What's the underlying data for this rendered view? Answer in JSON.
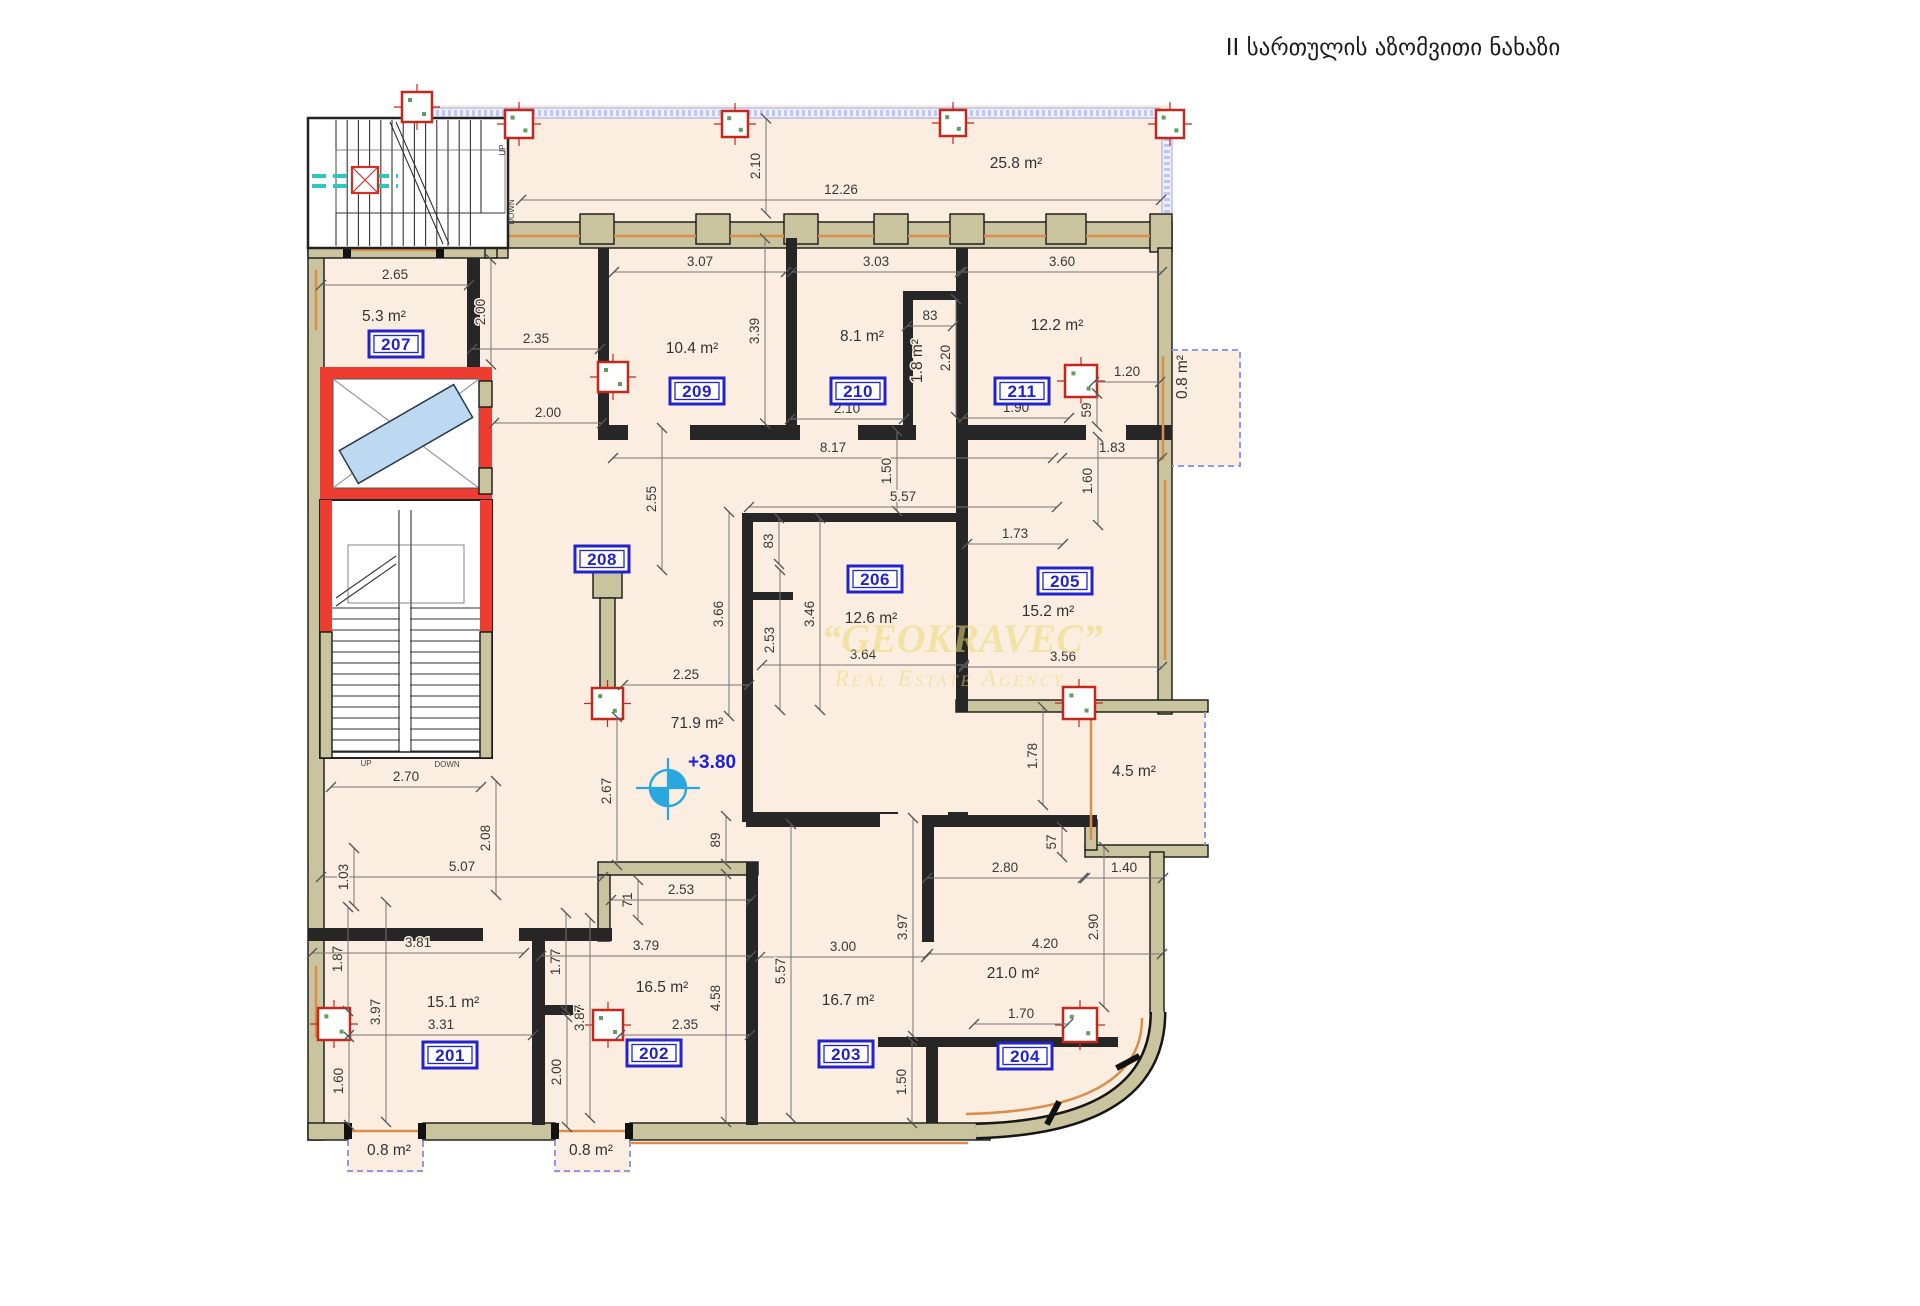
{
  "title": "II სართულის აზომვითი ნახაზი",
  "watermark": {
    "line1": "“GEOKRAVEC”",
    "line2": "Real Estate Agency"
  },
  "elevation": "+3.80",
  "accent_colors": {
    "wall_khaki": "#c9c49e",
    "room_fill": "#fbeee0",
    "label_blue": "#2323cc",
    "column_red": "#c4281c",
    "elevator_red": "#ee3c30",
    "railing_lavender": "#8f9be0",
    "window_orange": "#d98e4a",
    "watermark_gold": "#eed976",
    "survey_blue": "#2ba7e0",
    "section_teal": "#2cc8bc"
  },
  "rooms": [
    {
      "num": "201",
      "bx": 450,
      "by": 1055,
      "area": "15.1 m²",
      "ax": 453,
      "ay": 1007
    },
    {
      "num": "202",
      "bx": 654,
      "by": 1053,
      "area": "16.5 m²",
      "ax": 662,
      "ay": 992
    },
    {
      "num": "203",
      "bx": 846,
      "by": 1054,
      "area": "16.7 m²",
      "ax": 848,
      "ay": 1005
    },
    {
      "num": "204",
      "bx": 1025,
      "by": 1056,
      "area": "21.0 m²",
      "ax": 1013,
      "ay": 978
    },
    {
      "num": "205",
      "bx": 1065,
      "by": 581,
      "area": "15.2 m²",
      "ax": 1048,
      "ay": 616
    },
    {
      "num": "206",
      "bx": 875,
      "by": 579,
      "area": "12.6 m²",
      "ax": 871,
      "ay": 623
    },
    {
      "num": "207",
      "bx": 396,
      "by": 344,
      "area": "5.3 m²",
      "ax": 384,
      "ay": 321
    },
    {
      "num": "208",
      "bx": 602,
      "by": 559,
      "area": "",
      "ax": 0,
      "ay": 0
    },
    {
      "num": "209",
      "bx": 697,
      "by": 391,
      "area": "10.4 m²",
      "ax": 692,
      "ay": 353
    },
    {
      "num": "210",
      "bx": 858,
      "by": 391,
      "area": "8.1 m²",
      "ax": 862,
      "ay": 341
    },
    {
      "num": "211",
      "bx": 1022,
      "by": 391,
      "area": "12.2 m²",
      "ax": 1057,
      "ay": 330
    }
  ],
  "open_areas": [
    {
      "t": "25.8 m²",
      "x": 1016,
      "y": 168,
      "r": 0
    },
    {
      "t": "1.8 m²",
      "x": 922,
      "y": 361,
      "r": -90
    },
    {
      "t": "0.8 m²",
      "x": 1187,
      "y": 377,
      "r": -90
    },
    {
      "t": "4.5 m²",
      "x": 1134,
      "y": 776,
      "r": 0
    },
    {
      "t": "71.9 m²",
      "x": 697,
      "y": 728,
      "r": 0
    },
    {
      "t": "0.8 m²",
      "x": 389,
      "y": 1155,
      "r": 0
    },
    {
      "t": "0.8 m²",
      "x": 591,
      "y": 1155,
      "r": 0
    }
  ],
  "dims": [
    {
      "t": "2.10",
      "x": 760,
      "y": 166,
      "r": -90,
      "l": 95
    },
    {
      "t": "12.26",
      "x": 841,
      "y": 194,
      "r": 0,
      "l": 640
    },
    {
      "t": "2.65",
      "x": 395,
      "y": 279,
      "r": 0,
      "l": 148
    },
    {
      "t": "3.07",
      "x": 700,
      "y": 266,
      "r": 0,
      "l": 172
    },
    {
      "t": "3.03",
      "x": 876,
      "y": 266,
      "r": 0,
      "l": 168
    },
    {
      "t": "3.60",
      "x": 1062,
      "y": 266,
      "r": 0,
      "l": 200
    },
    {
      "t": "2.00",
      "x": 485,
      "y": 312,
      "r": -90,
      "l": 105
    },
    {
      "t": "2.35",
      "x": 536,
      "y": 343,
      "r": 0,
      "l": 128
    },
    {
      "t": "83",
      "x": 930,
      "y": 320,
      "r": 0,
      "l": 46
    },
    {
      "t": "2.20",
      "x": 950,
      "y": 358,
      "r": -90,
      "l": 118
    },
    {
      "t": "3.39",
      "x": 759,
      "y": 331,
      "r": -90,
      "l": 185
    },
    {
      "t": "2.10",
      "x": 847,
      "y": 413,
      "r": 0,
      "l": 114
    },
    {
      "t": "1.90",
      "x": 1016,
      "y": 412,
      "r": 0,
      "l": 106
    },
    {
      "t": "1.20",
      "x": 1127,
      "y": 376,
      "r": 0,
      "l": 66
    },
    {
      "t": "59",
      "x": 1091,
      "y": 410,
      "r": -90,
      "l": 33
    },
    {
      "t": "2.00",
      "x": 548,
      "y": 417,
      "r": 0,
      "l": 108
    },
    {
      "t": "8.17",
      "x": 833,
      "y": 452,
      "r": 0,
      "l": 440
    },
    {
      "t": "1.50",
      "x": 891,
      "y": 471,
      "r": -90,
      "l": 80
    },
    {
      "t": "5.57",
      "x": 903,
      "y": 501,
      "r": 0,
      "l": 308
    },
    {
      "t": "1.83",
      "x": 1112,
      "y": 452,
      "r": 0,
      "l": 100
    },
    {
      "t": "1.60",
      "x": 1092,
      "y": 481,
      "r": -90,
      "l": 88
    },
    {
      "t": "1.73",
      "x": 1015,
      "y": 538,
      "r": 0,
      "l": 96
    },
    {
      "t": "2.55",
      "x": 656,
      "y": 499,
      "r": -90,
      "l": 142
    },
    {
      "t": "3.66",
      "x": 723,
      "y": 614,
      "r": -90,
      "l": 204
    },
    {
      "t": "83",
      "x": 773,
      "y": 541,
      "r": -90,
      "l": 46
    },
    {
      "t": "2.53",
      "x": 774,
      "y": 640,
      "r": -90,
      "l": 140
    },
    {
      "t": "3.46",
      "x": 814,
      "y": 614,
      "r": -90,
      "l": 192
    },
    {
      "t": "3.64",
      "x": 863,
      "y": 659,
      "r": 0,
      "l": 202
    },
    {
      "t": "2.25",
      "x": 686,
      "y": 679,
      "r": 0,
      "l": 126
    },
    {
      "t": "3.56",
      "x": 1063,
      "y": 661,
      "r": 0,
      "l": 198
    },
    {
      "t": "2.67",
      "x": 611,
      "y": 791,
      "r": -90,
      "l": 148
    },
    {
      "t": "1.78",
      "x": 1037,
      "y": 756,
      "r": -90,
      "l": 98
    },
    {
      "t": "2.70",
      "x": 406,
      "y": 781,
      "r": 0,
      "l": 150
    },
    {
      "t": "2.08",
      "x": 490,
      "y": 838,
      "r": -90,
      "l": 114
    },
    {
      "t": "5.07",
      "x": 462,
      "y": 871,
      "r": 0,
      "l": 282
    },
    {
      "t": "1.03",
      "x": 348,
      "y": 877,
      "r": -90,
      "l": 58
    },
    {
      "t": "89",
      "x": 720,
      "y": 840,
      "r": -90,
      "l": 48
    },
    {
      "t": "71",
      "x": 632,
      "y": 900,
      "r": -90,
      "l": 40
    },
    {
      "t": "2.53",
      "x": 681,
      "y": 894,
      "r": 0,
      "l": 140
    },
    {
      "t": "57",
      "x": 1056,
      "y": 842,
      "r": -90,
      "l": 30
    },
    {
      "t": "2.80",
      "x": 1005,
      "y": 872,
      "r": 0,
      "l": 156
    },
    {
      "t": "1.40",
      "x": 1124,
      "y": 872,
      "r": 0,
      "l": 78
    },
    {
      "t": "3.97",
      "x": 907,
      "y": 927,
      "r": -90,
      "l": 218
    },
    {
      "t": "2.90",
      "x": 1098,
      "y": 927,
      "r": -90,
      "l": 160
    },
    {
      "t": "3.00",
      "x": 843,
      "y": 951,
      "r": 0,
      "l": 166
    },
    {
      "t": "5.57",
      "x": 785,
      "y": 971,
      "r": -90,
      "l": 294
    },
    {
      "t": "4.20",
      "x": 1045,
      "y": 948,
      "r": 0,
      "l": 234
    },
    {
      "t": "1.70",
      "x": 1021,
      "y": 1018,
      "r": 0,
      "l": 94
    },
    {
      "t": "1.87",
      "x": 342,
      "y": 959,
      "r": -90,
      "l": 104
    },
    {
      "t": "3.81",
      "x": 418,
      "y": 947,
      "r": 0,
      "l": 212
    },
    {
      "t": "3.97",
      "x": 380,
      "y": 1012,
      "r": -90,
      "l": 220
    },
    {
      "t": "3.31",
      "x": 441,
      "y": 1029,
      "r": 0,
      "l": 184
    },
    {
      "t": "1.60",
      "x": 343,
      "y": 1081,
      "r": -90,
      "l": 88
    },
    {
      "t": "1.77",
      "x": 560,
      "y": 962,
      "r": -90,
      "l": 98
    },
    {
      "t": "3.79",
      "x": 646,
      "y": 950,
      "r": 0,
      "l": 210
    },
    {
      "t": "3.87",
      "x": 584,
      "y": 1018,
      "r": -90,
      "l": 200
    },
    {
      "t": "4.58",
      "x": 720,
      "y": 998,
      "r": -90,
      "l": 248
    },
    {
      "t": "2.35",
      "x": 685,
      "y": 1029,
      "r": 0,
      "l": 130
    },
    {
      "t": "2.00",
      "x": 561,
      "y": 1072,
      "r": -90,
      "l": 110
    },
    {
      "t": "1.50",
      "x": 906,
      "y": 1082,
      "r": -90,
      "l": 82
    }
  ],
  "stair_labels": [
    {
      "t": "UP",
      "x": 505,
      "y": 150,
      "r": -90
    },
    {
      "t": "DOWN",
      "x": 514,
      "y": 212,
      "r": -90
    },
    {
      "t": "UP",
      "x": 366,
      "y": 766,
      "r": 0
    },
    {
      "t": "DOWN",
      "x": 447,
      "y": 767,
      "r": 0
    }
  ]
}
